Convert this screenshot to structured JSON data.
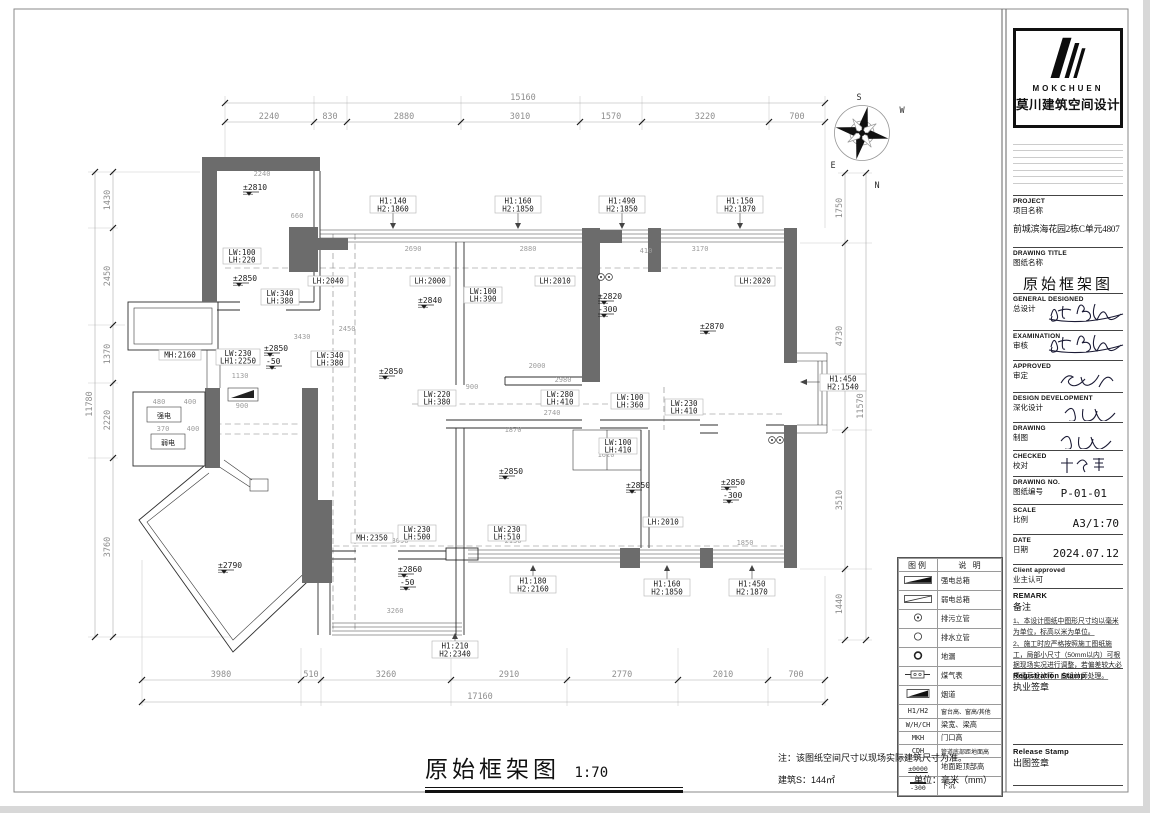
{
  "plan": {
    "dims": {
      "top": {
        "total": "15160",
        "segs": [
          "2240",
          "830",
          "2880",
          "3010",
          "1570",
          "3220",
          "700"
        ]
      },
      "bottom": {
        "total": "17160",
        "segs": [
          "3980",
          "510",
          "3260",
          "2910",
          "2770",
          "2010",
          "700"
        ]
      },
      "left": {
        "total": "11780",
        "segs": [
          "1430",
          "2450",
          "1370",
          "2220",
          "3760"
        ]
      },
      "right": {
        "total": "11570",
        "segs": [
          "1750",
          "4730",
          "3510",
          "1440"
        ]
      }
    },
    "windows": [
      {
        "l1": "H1:140",
        "l2": "H2:1860"
      },
      {
        "l1": "H1:160",
        "l2": "H2:1850"
      },
      {
        "l1": "H1:490",
        "l2": "H2:1850"
      },
      {
        "l1": "H1:150",
        "l2": "H2:1870"
      },
      {
        "l1": "H1:180",
        "l2": "H2:2160"
      },
      {
        "l1": "H1:210",
        "l2": "H2:2340"
      },
      {
        "l1": "H1:160",
        "l2": "H2:1850"
      },
      {
        "l1": "H1:450",
        "l2": "H2:1870"
      },
      {
        "l1": "H1:450",
        "l2": "H2:1540"
      }
    ],
    "beams": [
      "LH:2000",
      "LH:2010",
      "LH:2020",
      "LH:2040",
      "LH:2010"
    ],
    "lintels": [
      {
        "l1": "LW:100",
        "l2": "LH:220"
      },
      {
        "l1": "LW:340",
        "l2": "LH:380"
      },
      {
        "l1": "LW:230",
        "l2": "LH1:2250"
      },
      {
        "l1": "LW:340",
        "l2": "LH:380"
      },
      {
        "l1": "LW:100",
        "l2": "LH:390"
      },
      {
        "l1": "LW:220",
        "l2": "LH:380"
      },
      {
        "l1": "LW:280",
        "l2": "LH:410"
      },
      {
        "l1": "LW:100",
        "l2": "LH:360"
      },
      {
        "l1": "LW:230",
        "l2": "LH:410"
      },
      {
        "l1": "LW:100",
        "l2": "LH:410"
      },
      {
        "l1": "LW:230",
        "l2": "LH:500"
      },
      {
        "l1": "LW:230",
        "l2": "LH:510"
      }
    ],
    "doors": [
      "MH:2160",
      "MH:2350"
    ],
    "levels": [
      {
        "main": "±2810"
      },
      {
        "main": "±2850"
      },
      {
        "main": "±2850",
        "sub": "-50"
      },
      {
        "main": "±2840"
      },
      {
        "main": "±2820",
        "sub": "-300"
      },
      {
        "main": "±2870"
      },
      {
        "main": "±2850"
      },
      {
        "main": "±2790"
      },
      {
        "main": "±2860",
        "sub": "-50"
      },
      {
        "main": "±2850"
      },
      {
        "main": "±2850"
      },
      {
        "main": "±2850",
        "sub": "-300"
      }
    ],
    "minor_dims": [
      "2240",
      "660",
      "2690",
      "2880",
      "3170",
      "410",
      "2450",
      "3430",
      "1130",
      "900",
      "2000",
      "2980",
      "900",
      "2740",
      "1870",
      "1620",
      "2130",
      "3090",
      "1850",
      "3260",
      "480",
      "400",
      "370",
      "400"
    ],
    "electric": {
      "strong": "强电",
      "weak": "弱电"
    },
    "compass": {
      "n": "N",
      "s": "S",
      "e": "E",
      "w": "W"
    }
  },
  "legend": {
    "title_sym": "图例",
    "title_desc": "说 明",
    "rows": [
      {
        "icon": "strong-electric-box-icon",
        "sym": "",
        "desc": "强电总箱"
      },
      {
        "icon": "weak-electric-box-icon",
        "sym": "",
        "desc": "弱电总箱"
      },
      {
        "icon": "sewage-riser-icon",
        "sym": "",
        "desc": "排污立管"
      },
      {
        "icon": "drain-riser-icon",
        "sym": "",
        "desc": "排水立管"
      },
      {
        "icon": "floor-drain-icon",
        "sym": "",
        "desc": "地漏"
      },
      {
        "icon": "gas-meter-icon",
        "sym": "",
        "desc": "煤气表"
      },
      {
        "icon": "flue-icon",
        "sym": "",
        "desc": "烟道"
      },
      {
        "icon": "",
        "sym": "H1/H2",
        "desc": "窗台高、窗高/其他"
      },
      {
        "icon": "",
        "sym": "W/H/CH",
        "desc": "梁宽、梁高"
      },
      {
        "icon": "",
        "sym": "MKH",
        "desc": "门口高"
      },
      {
        "icon": "",
        "sym": "CDH",
        "desc": "管道底部距地面高"
      },
      {
        "icon": "level-mark-icon",
        "sym": "±0000",
        "desc": "地面距顶部高"
      },
      {
        "icon": "sunken-hatch-icon",
        "sym": "-300",
        "desc": "下沉"
      }
    ]
  },
  "title_block": {
    "brand": "MOKCHUEN",
    "brand_cn": "莫川建筑空间设计",
    "project": {
      "en": "PROJECT",
      "cn": "项目名称",
      "value": "前城滨海花园2栋C单元4807"
    },
    "drawing_title": {
      "en": "DRAWING TITLE",
      "cn": "图纸名称",
      "value": "原始框架图"
    },
    "sign_rows": [
      {
        "en": "GENERAL  DESIGNED",
        "cn": "总设计"
      },
      {
        "en": "EXAMINATION",
        "cn": "审核"
      },
      {
        "en": "APPROVED",
        "cn": "审定"
      },
      {
        "en": "DESIGN DEVELOPMENT",
        "cn": "深化设计"
      },
      {
        "en": "DRAWING",
        "cn": "制图"
      },
      {
        "en": "CHECKED",
        "cn": "校对"
      }
    ],
    "value_rows": [
      {
        "en": "DRAWING NO.",
        "cn": "图纸编号",
        "value": "P-01-01"
      },
      {
        "en": "SCALE",
        "cn": "比例",
        "value": "A3/1:70"
      },
      {
        "en": "DATE",
        "cn": "日期",
        "value": "2024.07.12"
      },
      {
        "en": "Client approved",
        "cn": "业主认可",
        "value": ""
      }
    ],
    "remark": {
      "en": "REMARK",
      "cn": "备注",
      "notes": [
        "1、本设计图纸中图形尺寸均以毫米为单位，标高以米为单位。",
        "2、施工时应严格按照施工图纸施工，局部小尺寸（50mm以内）可根据现场实况进行调整，若偏差较大必须请示设计师，由设计师处理。"
      ]
    },
    "registration": {
      "en": "Registration Stamp",
      "cn": "执业签章"
    },
    "release": {
      "en": "Release Stamp",
      "cn": "出图签章"
    }
  },
  "footer": {
    "title": "原始框架图",
    "scale": "1:70",
    "note": "注：该图纸空间尺寸以现场实际建筑尺寸为准。",
    "area": "建筑S：144㎡",
    "unit": "单位：毫米（mm）"
  }
}
